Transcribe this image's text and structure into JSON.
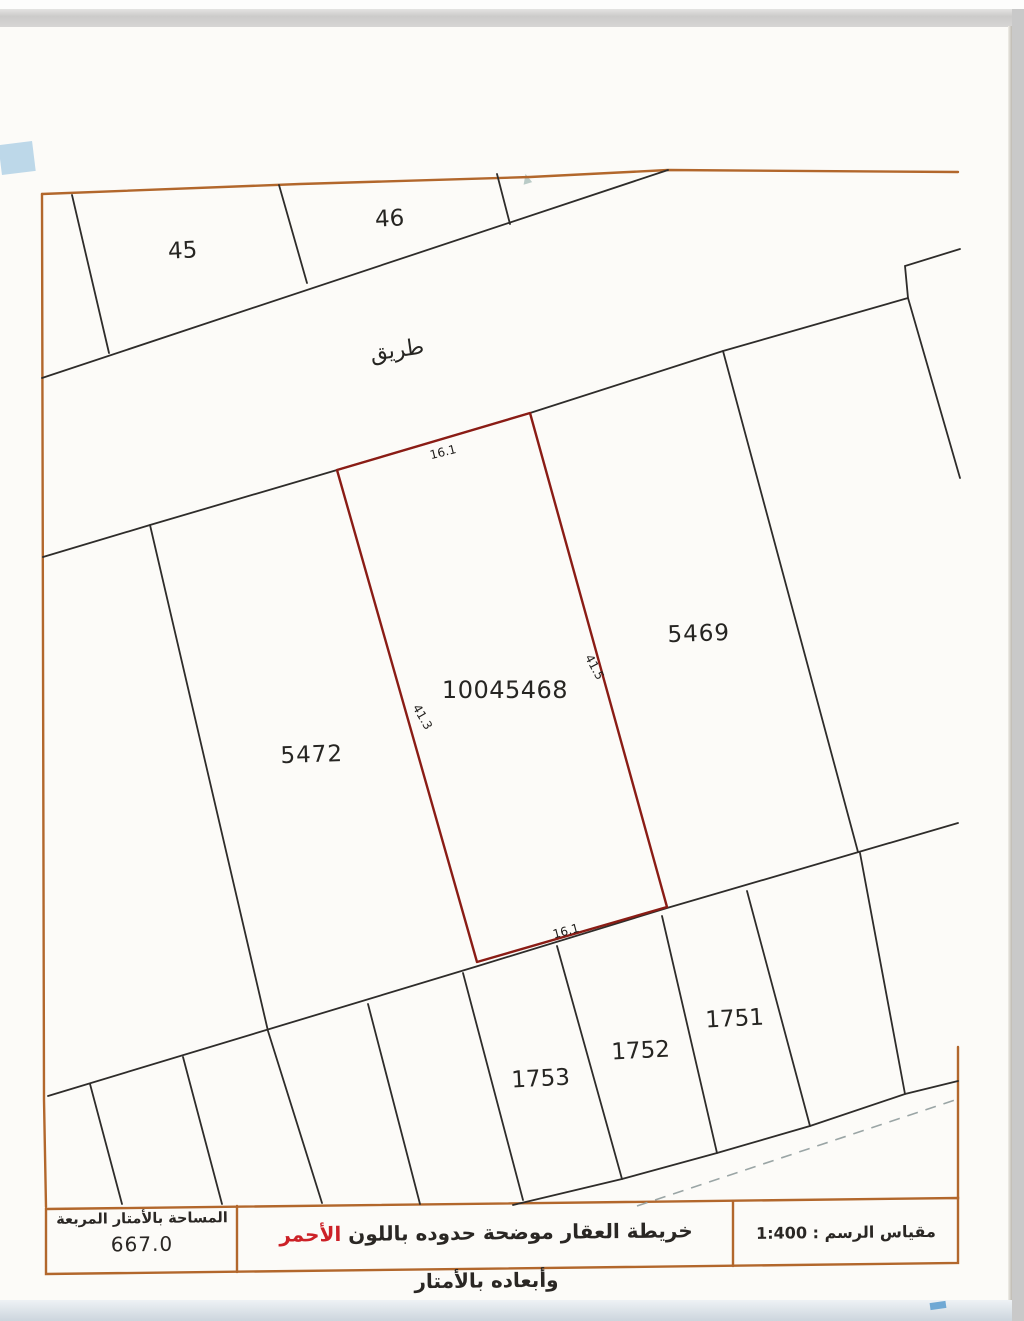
{
  "map": {
    "road_label": "طريق",
    "plots": {
      "plot_45": "45",
      "plot_46": "46",
      "plot_5472": "5472",
      "plot_5469": "5469",
      "plot_1753": "1753",
      "plot_1752": "1752",
      "plot_1751": "1751"
    },
    "subject_plot": {
      "number": "10045468",
      "dim_top": "16.1",
      "dim_bottom": "16.1",
      "dim_right": "41.5",
      "dim_left": "41.3",
      "boundary_color": "#8a1c15"
    },
    "colors": {
      "frame_orange": "#b2672c",
      "parcel_line_black": "#2e2c2a"
    }
  },
  "legend": {
    "area_box": {
      "label": "المساحة بالأمتار المربعة",
      "value": "667.0"
    },
    "note_box": {
      "prefix": "خريطة العقار موضحة حدوده باللون ",
      "highlight": "الأحمر",
      "suffix": " وأبعاده بالأمتار",
      "highlight_color": "#cc2127"
    },
    "scale_box": {
      "label": "مقياس الرسم : ",
      "value": "1:400"
    }
  }
}
